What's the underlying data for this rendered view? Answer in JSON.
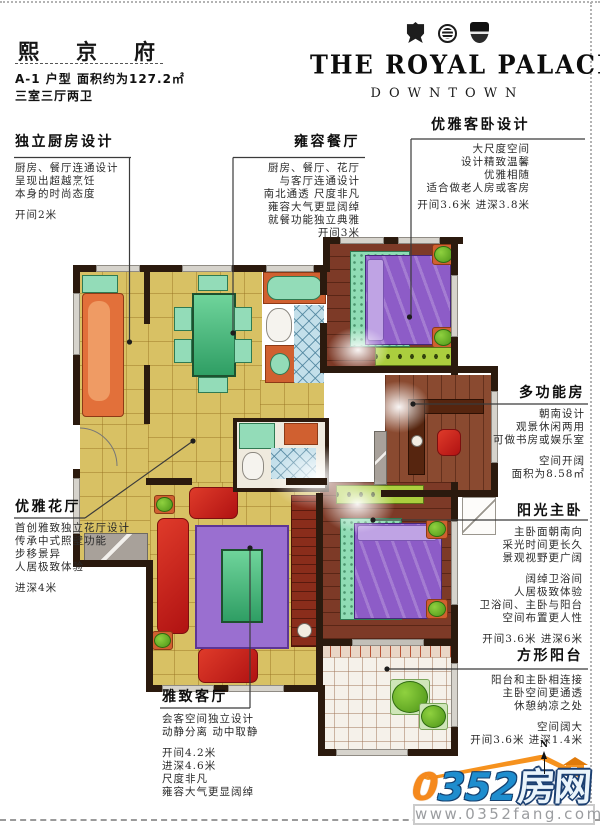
{
  "header": {
    "title": "熙京府",
    "unit_line": "A-1 户型  面积约为127.2㎡",
    "rooms_line": "三室三厅两卫"
  },
  "brand": {
    "name": "THE ROYAL PALACE",
    "tagline": "DOWNTOWN",
    "badges": [
      "crest-badge",
      "round-seal-badge",
      "shield-badge"
    ]
  },
  "callouts": {
    "kitchen": {
      "title": "独立厨房设计",
      "lines": [
        "厨房、餐厅连通设计",
        "呈现出超越烹饪",
        "本身的时尚态度"
      ],
      "dims": "开间2米"
    },
    "dining": {
      "title": "雍容餐厅",
      "lines": [
        "厨房、餐厅、花厅",
        "与客厅连通设计",
        "南北通透 尺度非凡",
        "雍容大气更显阔绰",
        "就餐功能独立典雅"
      ],
      "dims": "开间3米"
    },
    "guest": {
      "title": "优雅客卧设计",
      "lines": [
        "大尺度空间",
        "设计精致温馨",
        "优雅相随",
        "适合做老人房或客房"
      ],
      "dims": "开间3.6米  进深3.8米"
    },
    "multi": {
      "title": "多功能房",
      "lines": [
        "朝南设计",
        "观景休闲两用",
        "可做书房或娱乐室"
      ],
      "lines2": [
        "空间开阔",
        "面积为8.58㎡"
      ]
    },
    "master": {
      "title": "阳光主卧",
      "lines": [
        "主卧面朝南向",
        "采光时间更长久",
        "景观视野更广阔"
      ],
      "lines2": [
        "阔绰卫浴间",
        "人居极致体验",
        "卫浴间、主卧与阳台",
        "空间布置更人性"
      ],
      "dims": "开间3.6米  进深6米"
    },
    "balcony": {
      "title": "方形阳台",
      "lines": [
        "阳台和主卧相连接",
        "主卧空间更通透",
        "休憩纳凉之处"
      ],
      "lines2": [
        "空间阔大"
      ],
      "dims": "开间3.6米  进深1.4米"
    },
    "flower": {
      "title": "优雅花厅",
      "lines": [
        "首创雅致独立花厅设计",
        "传承中式照壁功能",
        "步移景异",
        "人居极致体验"
      ],
      "dims": "进深4米"
    },
    "living": {
      "title": "雅致客厅",
      "lines": [
        "会客空间独立设计",
        "动静分离 动中取静"
      ],
      "lines2": [
        "开间4.2米",
        "进深4.6米",
        "尺度非凡",
        "雍容大气更显阔绰"
      ]
    }
  },
  "footer": {
    "logo_prefix": "0",
    "logo_digits": "352",
    "logo_suffix": "房网",
    "website": "www.0352fang.com",
    "compass_label": "N"
  },
  "colors": {
    "accent_orange": "#f5891d",
    "logo_blue": "#1e8dce",
    "logo_navy": "#1b3f71",
    "wall_dark": "#2b1a0e",
    "floor_yellow": "#d8c164",
    "wood_brown": "#7d3a27",
    "bed_purple": "#8d5cc7",
    "mint_green": "#93dcb8",
    "sofa_red": "#c32020",
    "lime_green": "#abce3e",
    "tile_blue": "#c3dfea"
  }
}
